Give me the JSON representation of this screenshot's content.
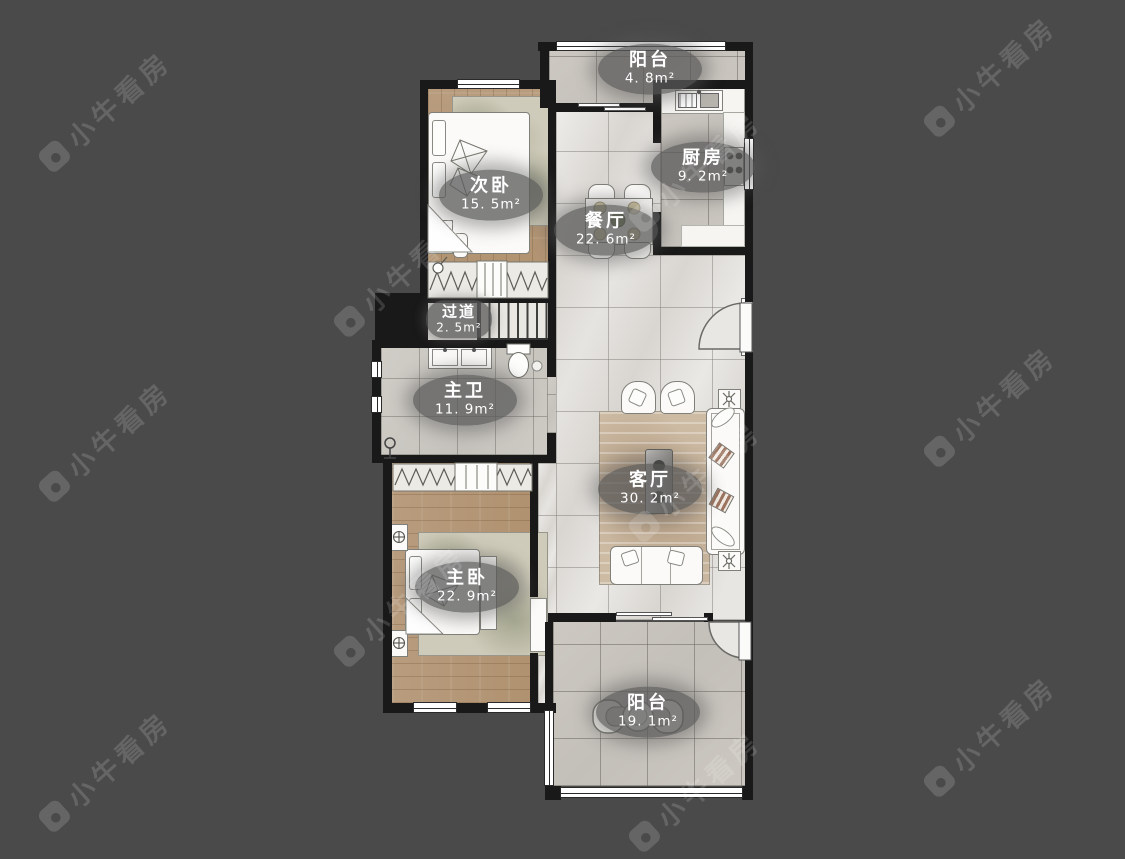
{
  "watermark": {
    "text": "小牛看房"
  },
  "rooms": [
    {
      "id": "balcony-top",
      "name": "阳台",
      "area": "4. 8m²"
    },
    {
      "id": "kitchen",
      "name": "厨房",
      "area": "9. 2m²"
    },
    {
      "id": "bedroom-second",
      "name": "次卧",
      "area": "15. 5m²"
    },
    {
      "id": "dining",
      "name": "餐厅",
      "area": "22. 6m²"
    },
    {
      "id": "hallway",
      "name": "过道",
      "area": "2. 5m²"
    },
    {
      "id": "bathroom-master",
      "name": "主卫",
      "area": "11. 9m²"
    },
    {
      "id": "living",
      "name": "客厅",
      "area": "30. 2m²"
    },
    {
      "id": "bedroom-master",
      "name": "主卧",
      "area": "22. 9m²"
    },
    {
      "id": "balcony-bottom",
      "name": "阳台",
      "area": "19. 1m²"
    }
  ],
  "colors": {
    "background": "#4a4a4a",
    "wall": "#191919",
    "wood_floor": "#b5997a",
    "tile_light": "#d9d6d1",
    "tile_gray": "#c9c5bf",
    "label_bubble": "#585858",
    "watermark": "#ffffff"
  }
}
